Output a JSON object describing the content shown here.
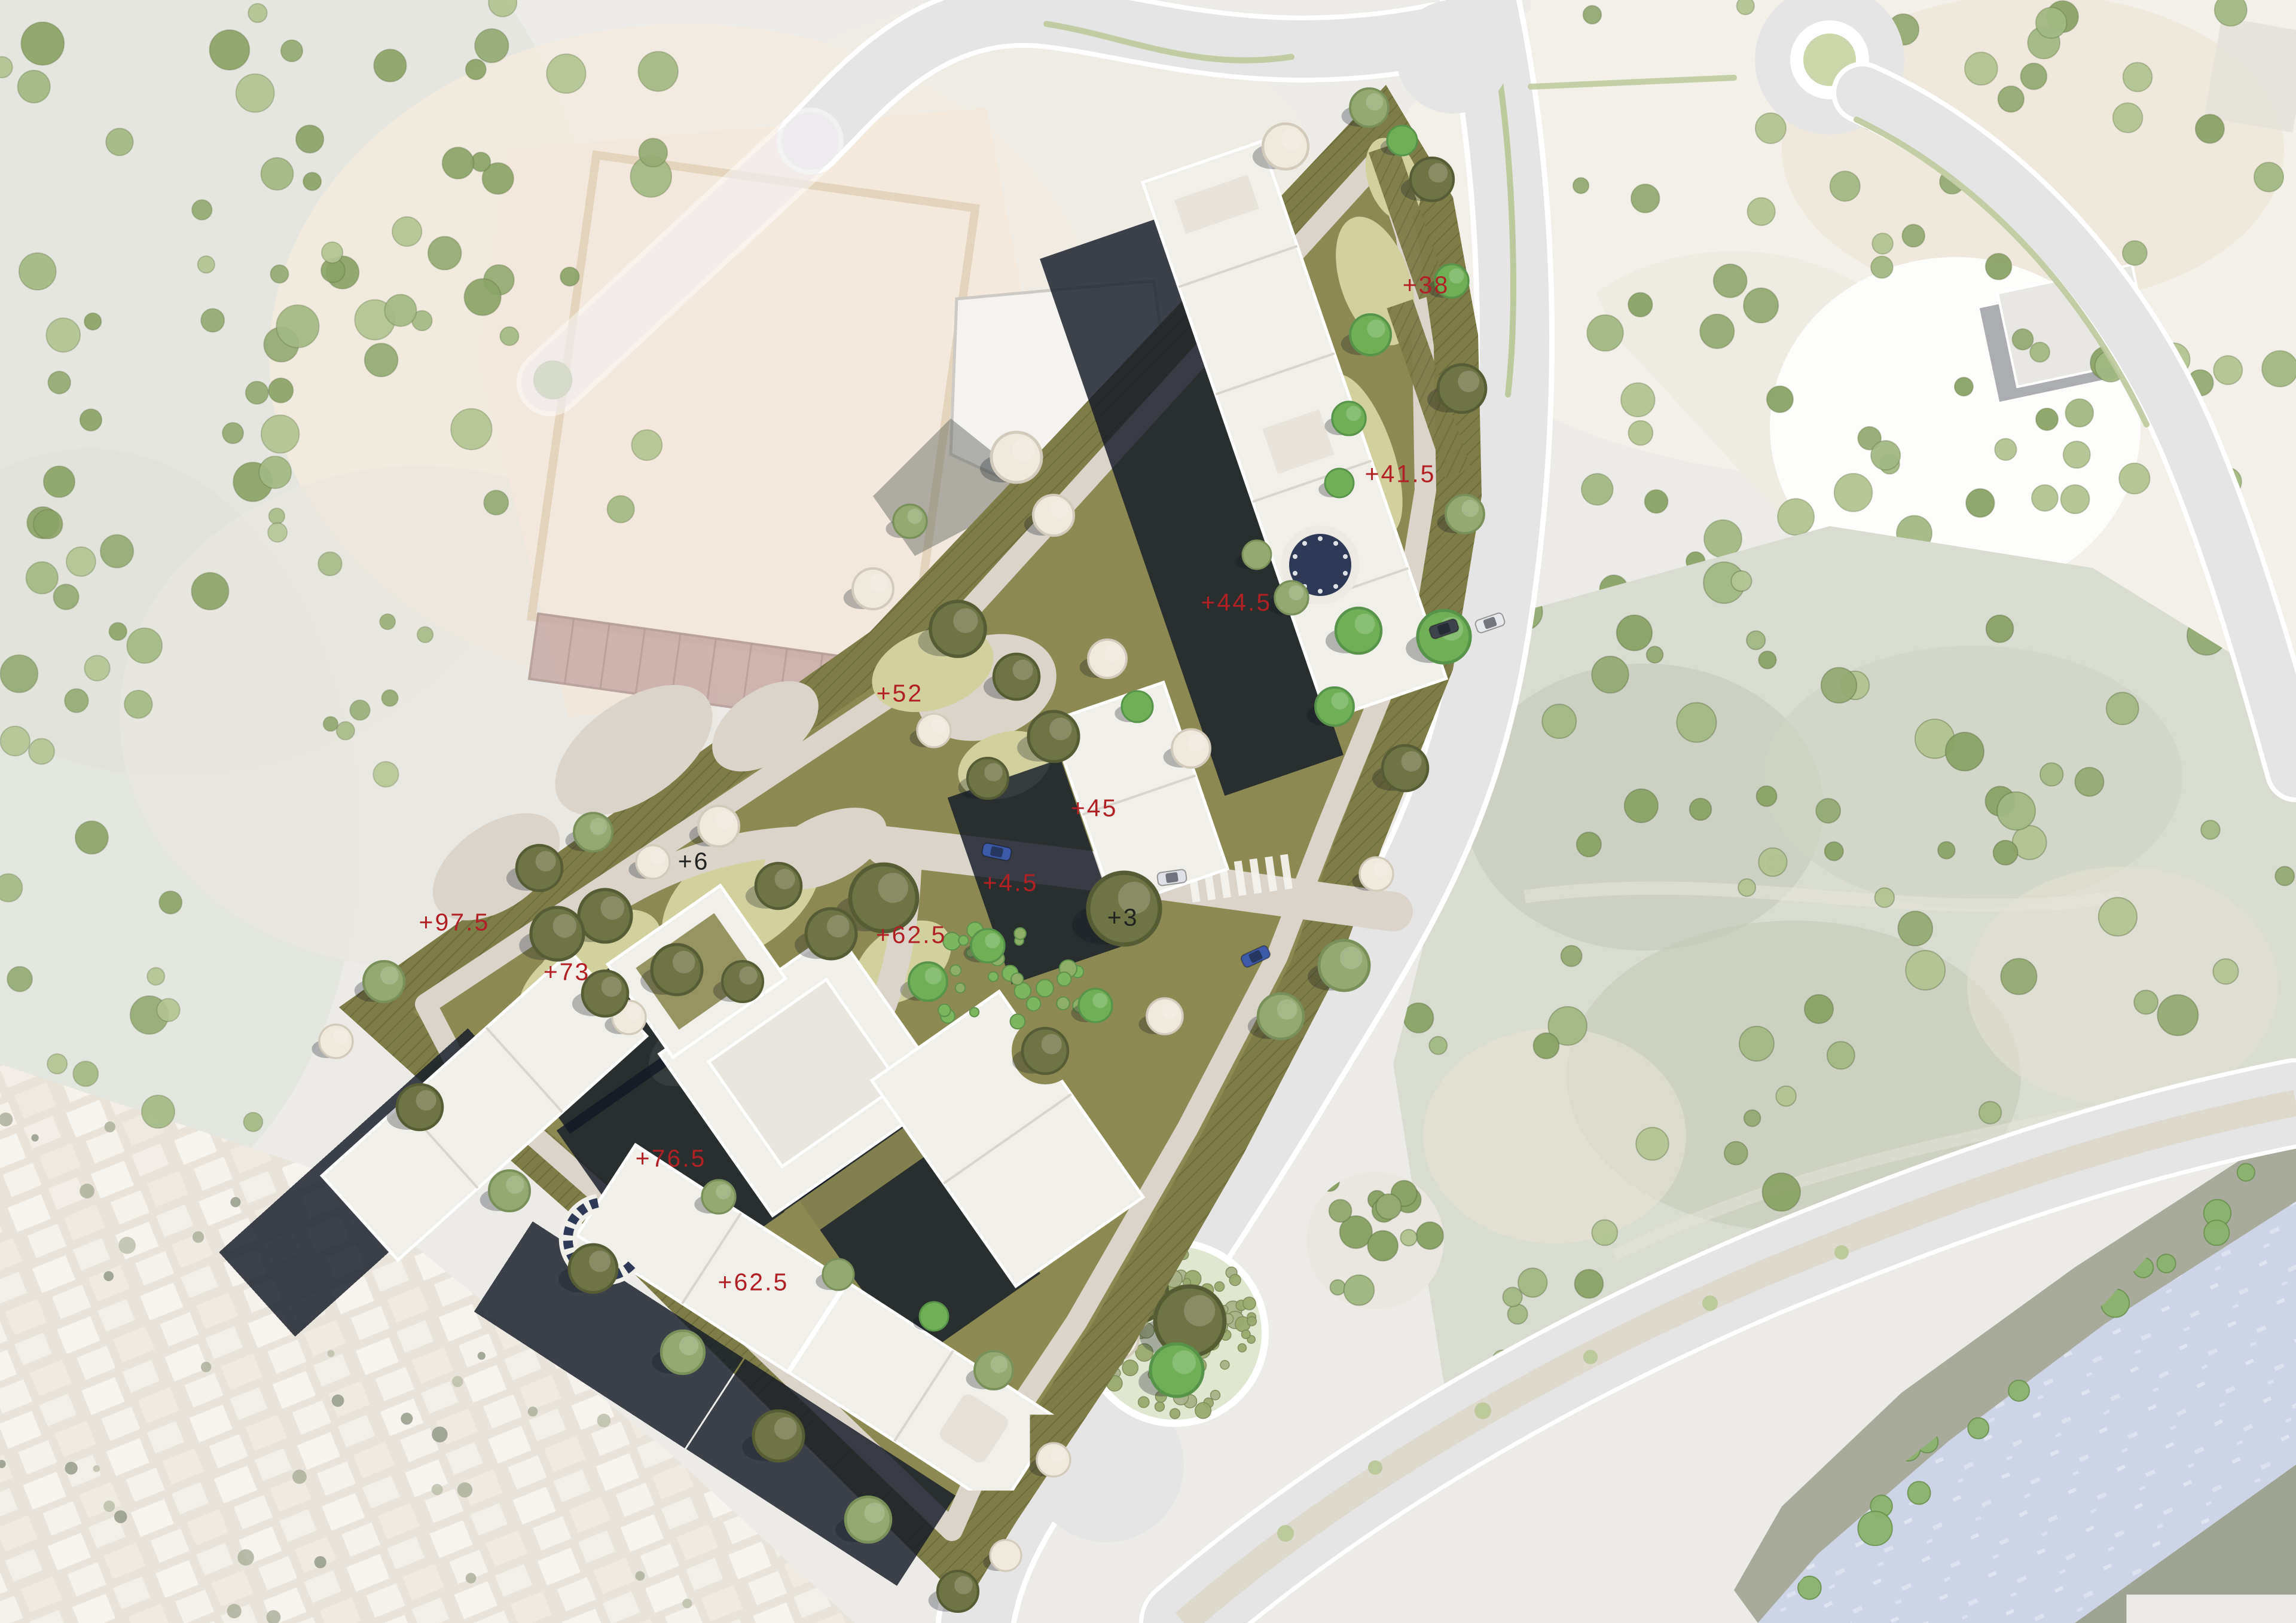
{
  "map": {
    "kind": "architectural-masterplan-site-plan-over-aerial",
    "palette": {
      "label-red": "#b02025",
      "label-black": "#222220",
      "site-olive": "#8c8a52",
      "site-olive-dark": "#7e7c47",
      "lawn-pale": "#d2d19e",
      "path-pale": "#dad4cb",
      "road-gray": "#e6e5e6",
      "road-edge": "#ffffff",
      "median-sage": "#bcc99c",
      "building-roof": "#f1efe9",
      "building-shadow": "#141a26",
      "pool-navy": "#2e3a55",
      "water-blue": "#ccd4e6",
      "aerial-wash": "#ecebe8",
      "tree-olive": "#6e7444",
      "tree-sage": "#93a96f",
      "tree-bright": "#6fb057",
      "tree-blossom": "#efe9de"
    },
    "features": [
      "proposed-housing-blocks",
      "landscaped-courtyards",
      "circular-pool",
      "amphitheater-steps",
      "perimeter-paths",
      "boulevard-road",
      "roundabout",
      "round-planted-garden",
      "white-plaza",
      "tree-park",
      "river",
      "informal-housing-fabric",
      "construction-site",
      "orchard-scatter-trees"
    ]
  },
  "elevation_labels": [
    {
      "text": "+38",
      "color": "red",
      "x_pct": 62.11,
      "y_pct": 17.57
    },
    {
      "text": "+41.5",
      "color": "red",
      "x_pct": 60.99,
      "y_pct": 29.21
    },
    {
      "text": "+44.5",
      "color": "red",
      "x_pct": 53.85,
      "y_pct": 37.13
    },
    {
      "text": "+52",
      "color": "red",
      "x_pct": 39.19,
      "y_pct": 42.73
    },
    {
      "text": "+45",
      "color": "red",
      "x_pct": 47.66,
      "y_pct": 49.8
    },
    {
      "text": "+4.5",
      "color": "red",
      "x_pct": 44.01,
      "y_pct": 54.4
    },
    {
      "text": "+3",
      "color": "black",
      "x_pct": 48.91,
      "y_pct": 56.54
    },
    {
      "text": "+6",
      "color": "black",
      "x_pct": 30.21,
      "y_pct": 53.08
    },
    {
      "text": "+62.5",
      "color": "red",
      "x_pct": 39.69,
      "y_pct": 57.61
    },
    {
      "text": "+97.5",
      "color": "red",
      "x_pct": 19.79,
      "y_pct": 56.83
    },
    {
      "text": "+73",
      "color": "red",
      "x_pct": 24.69,
      "y_pct": 59.89
    },
    {
      "text": "+76.5",
      "color": "red",
      "x_pct": 29.22,
      "y_pct": 71.38
    },
    {
      "text": "+62.5",
      "color": "red",
      "x_pct": 32.81,
      "y_pct": 79.01
    }
  ]
}
